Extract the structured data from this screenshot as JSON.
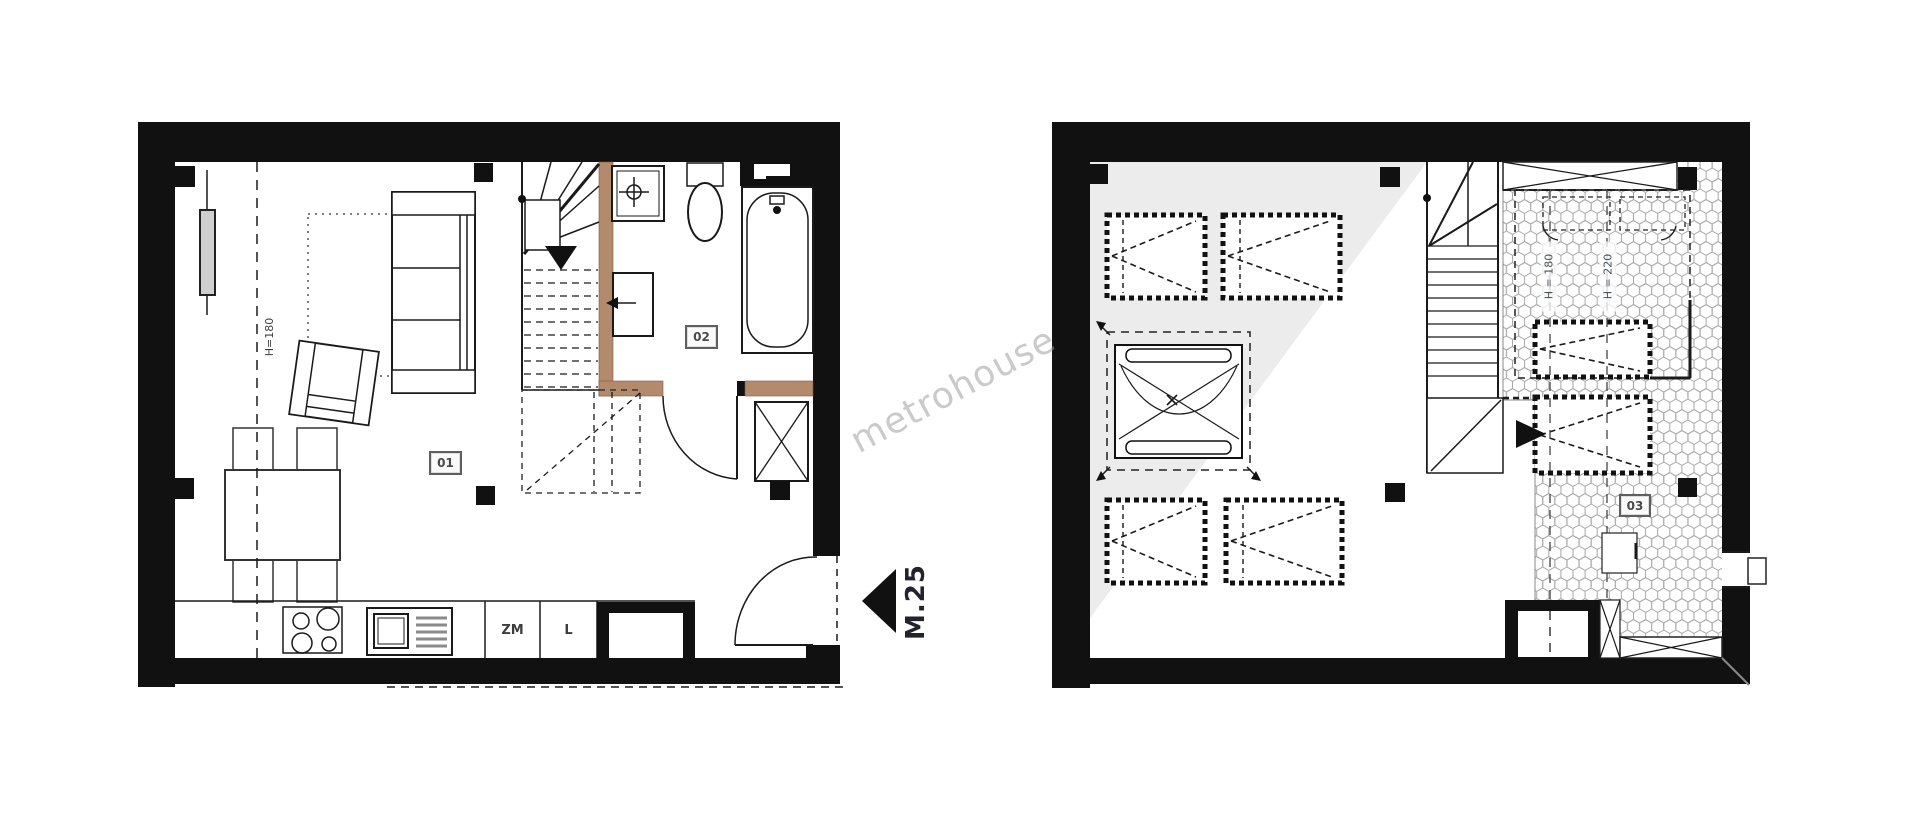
{
  "watermark": {
    "text": "metrohouse"
  },
  "floor1": {
    "rooms": {
      "living_kitchen": "01",
      "bathroom": "02"
    },
    "kitchen_units": {
      "dishwasher": "ZM",
      "fridge": "L"
    },
    "height_line_label": "H=180",
    "entrance_marker": "M.25"
  },
  "floor2": {
    "rooms": {
      "attic": "03"
    },
    "height_line_180_label": "H = 180",
    "height_line_220_label": "H = 220"
  },
  "colors": {
    "wall": "#111111",
    "interior_wall_accent": "#b48a6c",
    "low_ceiling_shade": "#ececec",
    "watermark": "#9a9a9a"
  }
}
